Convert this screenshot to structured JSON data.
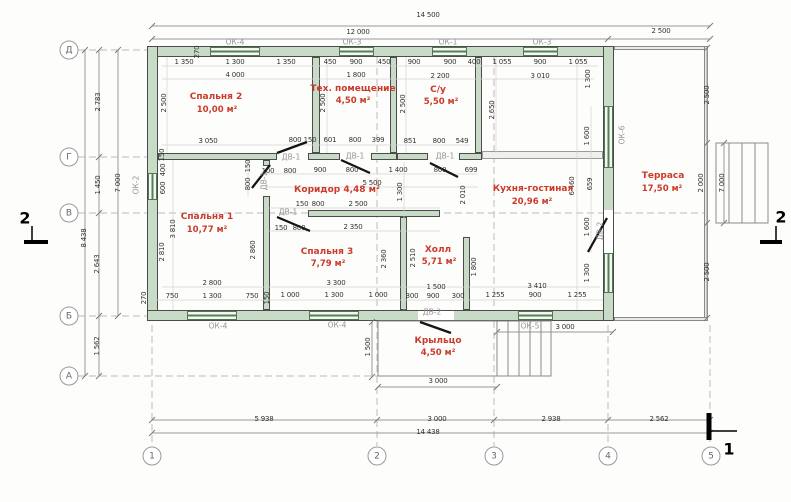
{
  "colors": {
    "wall": "#c7dbc7",
    "room_label": "#cb3a2b",
    "dimension_text": "#333333",
    "fixture_text": "#949494"
  },
  "rooms": [
    {
      "name": "Спальня 2",
      "area": "10,00 м²",
      "nx": 216,
      "ny": 97,
      "ax": 217,
      "ay": 110
    },
    {
      "name": "Тех. помещение",
      "area": "4,50 м²",
      "nx": 353,
      "ny": 89,
      "ax": 353,
      "ay": 101
    },
    {
      "name": "С/у",
      "area": "5,50 м²",
      "nx": 438,
      "ny": 90,
      "ax": 441,
      "ay": 102
    },
    {
      "name": "Кухня-гостиная",
      "area": "20,96 м²",
      "nx": 533,
      "ny": 189,
      "ax": 532,
      "ay": 202
    },
    {
      "name": "Терраса",
      "area": "17,50 м²",
      "nx": 663,
      "ny": 176,
      "ax": 662,
      "ay": 189
    },
    {
      "name": "Спальня 1",
      "area": "10,77 м²",
      "nx": 207,
      "ny": 217,
      "ax": 207,
      "ay": 230
    },
    {
      "name": "Коридор",
      "area": "4,48 м²",
      "inline": true,
      "nx": 337,
      "ny": 190
    },
    {
      "name": "Спальня 3",
      "area": "7,79 м²",
      "nx": 327,
      "ny": 252,
      "ax": 328,
      "ay": 264
    },
    {
      "name": "Холл",
      "area": "5,71 м²",
      "nx": 438,
      "ny": 250,
      "ax": 439,
      "ay": 262
    },
    {
      "name": "Крыльцо",
      "area": "4,50 м²",
      "nx": 438,
      "ny": 341,
      "ax": 438,
      "ay": 353
    }
  ],
  "dimensions": [
    {
      "t": "14 500",
      "x": 428,
      "y": 15
    },
    {
      "t": "12 000",
      "x": 358,
      "y": 32
    },
    {
      "t": "2 500",
      "x": 661,
      "y": 31
    },
    {
      "t": "1 350",
      "x": 184,
      "y": 62
    },
    {
      "t": "1 300",
      "x": 235,
      "y": 62
    },
    {
      "t": "1 350",
      "x": 286,
      "y": 62
    },
    {
      "t": "450",
      "x": 330,
      "y": 62
    },
    {
      "t": "900",
      "x": 356,
      "y": 62
    },
    {
      "t": "450",
      "x": 384,
      "y": 62
    },
    {
      "t": "900",
      "x": 414,
      "y": 62
    },
    {
      "t": "900",
      "x": 450,
      "y": 62
    },
    {
      "t": "400",
      "x": 474,
      "y": 62
    },
    {
      "t": "1 055",
      "x": 502,
      "y": 62
    },
    {
      "t": "900",
      "x": 540,
      "y": 62
    },
    {
      "t": "1 055",
      "x": 578,
      "y": 62
    },
    {
      "t": "4 000",
      "x": 235,
      "y": 75
    },
    {
      "t": "1 800",
      "x": 356,
      "y": 75
    },
    {
      "t": "2 200",
      "x": 440,
      "y": 76
    },
    {
      "t": "3 010",
      "x": 540,
      "y": 76
    },
    {
      "t": "2 500",
      "x": 164,
      "y": 103,
      "v": true
    },
    {
      "t": "2 500",
      "x": 323,
      "y": 103,
      "v": true
    },
    {
      "t": "2 500",
      "x": 403,
      "y": 104,
      "v": true
    },
    {
      "t": "2 650",
      "x": 492,
      "y": 110,
      "v": true
    },
    {
      "t": "1 300",
      "x": 588,
      "y": 79,
      "v": true
    },
    {
      "t": "270",
      "x": 197,
      "y": 52,
      "v": true
    },
    {
      "t": "3 050",
      "x": 208,
      "y": 141
    },
    {
      "t": "800",
      "x": 295,
      "y": 140
    },
    {
      "t": "150",
      "x": 310,
      "y": 140
    },
    {
      "t": "601",
      "x": 330,
      "y": 140
    },
    {
      "t": "800",
      "x": 355,
      "y": 140
    },
    {
      "t": "399",
      "x": 378,
      "y": 140
    },
    {
      "t": "851",
      "x": 410,
      "y": 141
    },
    {
      "t": "800",
      "x": 439,
      "y": 141
    },
    {
      "t": "549",
      "x": 462,
      "y": 141
    },
    {
      "t": "100",
      "x": 268,
      "y": 171
    },
    {
      "t": "800",
      "x": 290,
      "y": 171
    },
    {
      "t": "900",
      "x": 320,
      "y": 170
    },
    {
      "t": "800",
      "x": 352,
      "y": 170
    },
    {
      "t": "1 400",
      "x": 398,
      "y": 170
    },
    {
      "t": "800",
      "x": 440,
      "y": 170
    },
    {
      "t": "699",
      "x": 471,
      "y": 170
    },
    {
      "t": "5 500",
      "x": 372,
      "y": 183
    },
    {
      "t": "150",
      "x": 302,
      "y": 204
    },
    {
      "t": "800",
      "x": 318,
      "y": 204
    },
    {
      "t": "2 500",
      "x": 358,
      "y": 204
    },
    {
      "t": "150",
      "x": 281,
      "y": 228
    },
    {
      "t": "800",
      "x": 299,
      "y": 228
    },
    {
      "t": "2 350",
      "x": 353,
      "y": 227
    },
    {
      "t": "150",
      "x": 162,
      "y": 155,
      "v": true
    },
    {
      "t": "400",
      "x": 163,
      "y": 170,
      "v": true
    },
    {
      "t": "600",
      "x": 163,
      "y": 188,
      "v": true
    },
    {
      "t": "3 810",
      "x": 173,
      "y": 229,
      "v": true
    },
    {
      "t": "2 810",
      "x": 162,
      "y": 252,
      "v": true
    },
    {
      "t": "150",
      "x": 248,
      "y": 166,
      "v": true
    },
    {
      "t": "800",
      "x": 248,
      "y": 184,
      "v": true
    },
    {
      "t": "1 300",
      "x": 400,
      "y": 192,
      "v": true
    },
    {
      "t": "2 010",
      "x": 463,
      "y": 195,
      "v": true
    },
    {
      "t": "2 860",
      "x": 253,
      "y": 250,
      "v": true
    },
    {
      "t": "2 360",
      "x": 384,
      "y": 259,
      "v": true
    },
    {
      "t": "2 510",
      "x": 413,
      "y": 258,
      "v": true
    },
    {
      "t": "1 800",
      "x": 474,
      "y": 267,
      "v": true
    },
    {
      "t": "6 460",
      "x": 572,
      "y": 186,
      "v": true
    },
    {
      "t": "659",
      "x": 590,
      "y": 184,
      "v": true
    },
    {
      "t": "1 600",
      "x": 587,
      "y": 136,
      "v": true
    },
    {
      "t": "1 600",
      "x": 587,
      "y": 227,
      "v": true
    },
    {
      "t": "1 300",
      "x": 587,
      "y": 273,
      "v": true
    },
    {
      "t": "2 500",
      "x": 707,
      "y": 95,
      "v": true
    },
    {
      "t": "2 000",
      "x": 701,
      "y": 183,
      "v": true
    },
    {
      "t": "7 000",
      "x": 722,
      "y": 183,
      "v": true
    },
    {
      "t": "2 500",
      "x": 707,
      "y": 272,
      "v": true
    },
    {
      "t": "2 800",
      "x": 212,
      "y": 283
    },
    {
      "t": "3 300",
      "x": 336,
      "y": 283
    },
    {
      "t": "1 500",
      "x": 436,
      "y": 287
    },
    {
      "t": "3 410",
      "x": 537,
      "y": 286
    },
    {
      "t": "270",
      "x": 144,
      "y": 298,
      "v": true
    },
    {
      "t": "750",
      "x": 172,
      "y": 296
    },
    {
      "t": "1 300",
      "x": 212,
      "y": 296
    },
    {
      "t": "750",
      "x": 252,
      "y": 296
    },
    {
      "t": "150",
      "x": 267,
      "y": 298,
      "v": true
    },
    {
      "t": "1 000",
      "x": 290,
      "y": 295
    },
    {
      "t": "1 300",
      "x": 334,
      "y": 295
    },
    {
      "t": "1 000",
      "x": 378,
      "y": 295
    },
    {
      "t": "300",
      "x": 412,
      "y": 296
    },
    {
      "t": "900",
      "x": 433,
      "y": 296
    },
    {
      "t": "300",
      "x": 458,
      "y": 296
    },
    {
      "t": "1 255",
      "x": 495,
      "y": 295
    },
    {
      "t": "900",
      "x": 535,
      "y": 295
    },
    {
      "t": "1 255",
      "x": 577,
      "y": 295
    },
    {
      "t": "1 500",
      "x": 368,
      "y": 347,
      "v": true
    },
    {
      "t": "3 000",
      "x": 438,
      "y": 381
    },
    {
      "t": "3 000",
      "x": 565,
      "y": 327
    },
    {
      "t": "5 938",
      "x": 264,
      "y": 419
    },
    {
      "t": "3 000",
      "x": 437,
      "y": 419
    },
    {
      "t": "2 938",
      "x": 551,
      "y": 419
    },
    {
      "t": "2 562",
      "x": 659,
      "y": 419
    },
    {
      "t": "14 438",
      "x": 428,
      "y": 432
    },
    {
      "t": "2 783",
      "x": 98,
      "y": 102,
      "v": true
    },
    {
      "t": "1 450",
      "x": 98,
      "y": 185,
      "v": true
    },
    {
      "t": "2 643",
      "x": 97,
      "y": 264,
      "v": true
    },
    {
      "t": "1 562",
      "x": 97,
      "y": 346,
      "v": true
    },
    {
      "t": "7 000",
      "x": 118,
      "y": 183,
      "v": true
    },
    {
      "t": "8 438",
      "x": 84,
      "y": 238,
      "v": true
    }
  ],
  "fixtures": [
    {
      "t": "ОК-4",
      "x": 235,
      "y": 42
    },
    {
      "t": "ОК-3",
      "x": 352,
      "y": 42
    },
    {
      "t": "ОК-1",
      "x": 448,
      "y": 42
    },
    {
      "t": "ОК-3",
      "x": 542,
      "y": 42
    },
    {
      "t": "ОК-2",
      "x": 136,
      "y": 185,
      "v": true
    },
    {
      "t": "ОК-6",
      "x": 622,
      "y": 135,
      "v": true
    },
    {
      "t": "ОК-4",
      "x": 218,
      "y": 326
    },
    {
      "t": "ОК-4",
      "x": 337,
      "y": 325
    },
    {
      "t": "ОК-5",
      "x": 530,
      "y": 326
    },
    {
      "t": "ДВ-2",
      "x": 432,
      "y": 312
    },
    {
      "t": "ДВ-1",
      "x": 291,
      "y": 157
    },
    {
      "t": "ДВ-1",
      "x": 355,
      "y": 156
    },
    {
      "t": "ДВ-1",
      "x": 445,
      "y": 156
    },
    {
      "t": "ДВ-1",
      "x": 264,
      "y": 181,
      "v": true
    },
    {
      "t": "ДВ-1",
      "x": 288,
      "y": 212
    },
    {
      "t": "ДВ-2",
      "x": 600,
      "y": 231,
      "v": true
    }
  ],
  "axes": {
    "row_x": 69,
    "col_y": 456,
    "rows": [
      {
        "label": "Д",
        "y": 50
      },
      {
        "label": "Г",
        "y": 157
      },
      {
        "label": "В",
        "y": 213
      },
      {
        "label": "Б",
        "y": 316
      },
      {
        "label": "А",
        "y": 376
      }
    ],
    "cols": [
      {
        "label": "1",
        "x": 152
      },
      {
        "label": "2",
        "x": 377
      },
      {
        "label": "3",
        "x": 494
      },
      {
        "label": "4",
        "x": 608
      },
      {
        "label": "5",
        "x": 711
      }
    ]
  },
  "sections": [
    {
      "label": "2",
      "x": 25,
      "y": 218
    },
    {
      "label": "2",
      "x": 781,
      "y": 217
    },
    {
      "label": "1",
      "x": 729,
      "y": 449
    }
  ]
}
